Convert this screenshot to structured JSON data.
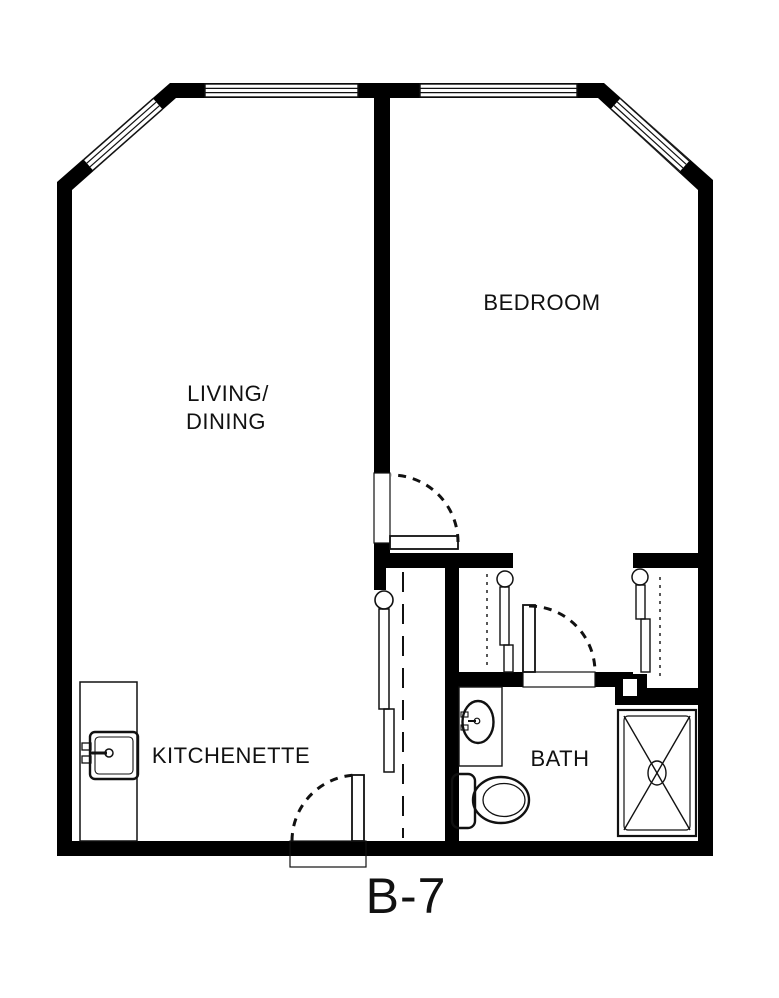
{
  "unit": {
    "label": "B-7"
  },
  "rooms": {
    "living_dining": {
      "label_line1": "LIVING/",
      "label_line2": "DINING"
    },
    "bedroom": {
      "label": "BEDROOM"
    },
    "kitchenette": {
      "label": "KITCHENETTE"
    },
    "bath": {
      "label": "BATH"
    }
  },
  "fixtures": {
    "kitchen_sink": "kitchen-sink",
    "bath_sink": "vanity-sink",
    "toilet": "toilet",
    "shower": "shower-stall"
  },
  "symbols": {
    "windows": [
      "window-top-left-diagonal",
      "window-top-left",
      "window-top-right",
      "window-top-right-diagonal"
    ],
    "doors": [
      "entry-door",
      "bedroom-door",
      "bath-door"
    ],
    "closets": [
      "hall-closet",
      "linen-closet",
      "bedroom-closet"
    ]
  },
  "colors": {
    "wall": "#000000",
    "background": "#ffffff",
    "line": "#111111"
  }
}
